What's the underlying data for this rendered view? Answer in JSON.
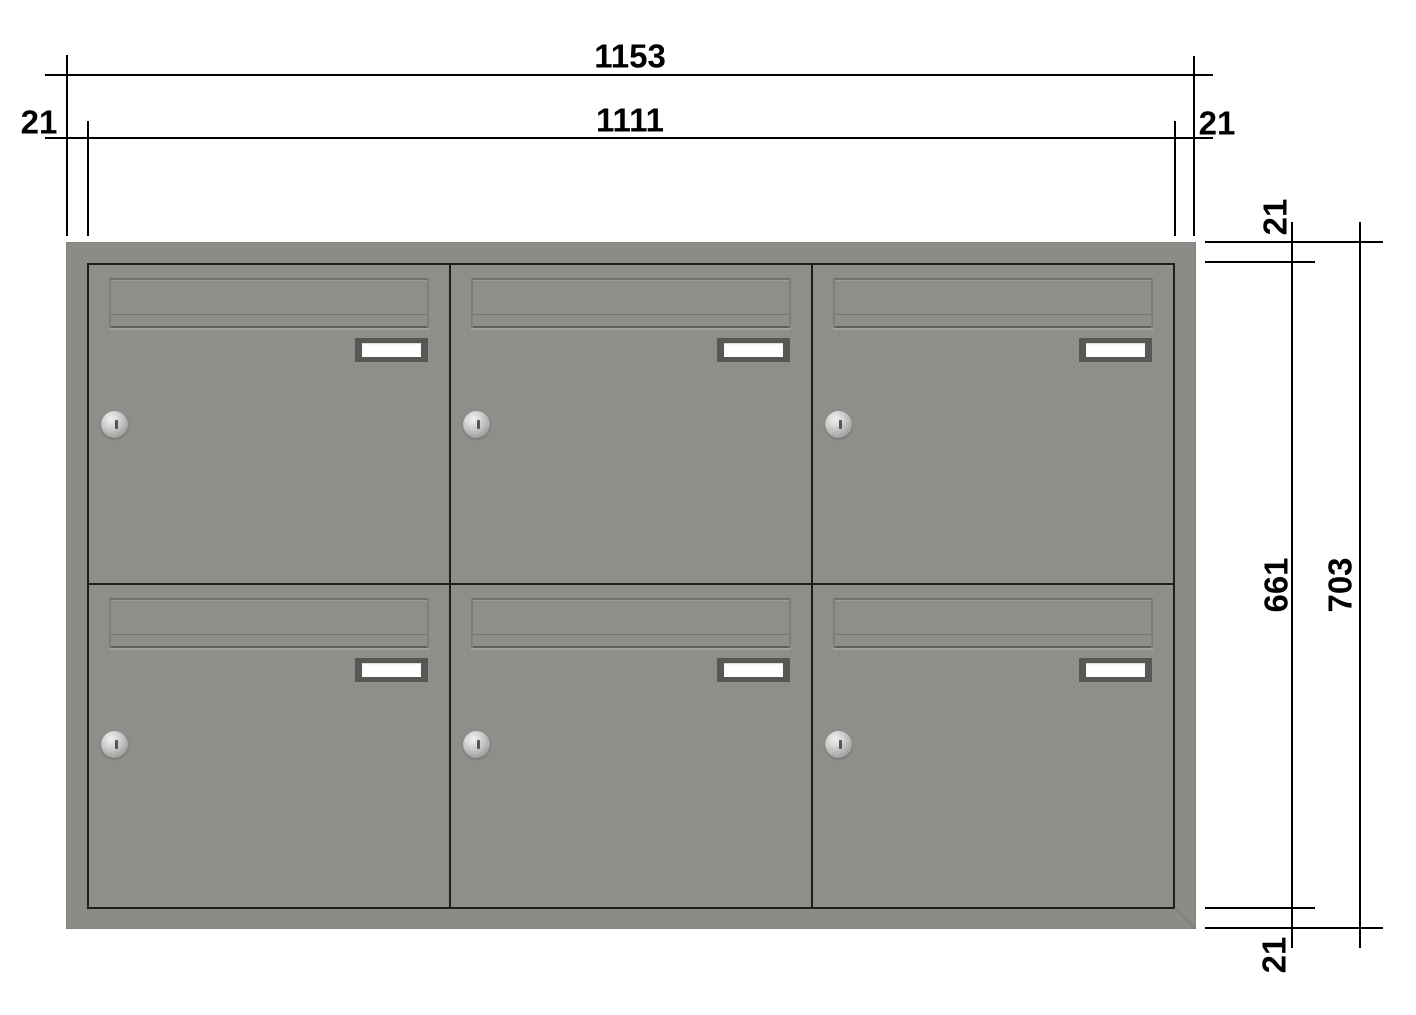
{
  "dimensions": {
    "overall_width": "1153",
    "body_width": "1111",
    "left_offset": "21",
    "right_offset": "21",
    "top_offset": "21",
    "body_height": "661",
    "overall_height": "703",
    "bottom_offset": "21"
  },
  "cabinet": {
    "rows": 2,
    "columns": 3,
    "box_count": 6
  },
  "colors": {
    "line": "#000000",
    "text": "#000000",
    "frame": "#8a8c87",
    "door": "#8d8f8a",
    "divider": "#1d1f1c",
    "plateFrame": "#565853",
    "plateWindow": "#ffffff"
  }
}
